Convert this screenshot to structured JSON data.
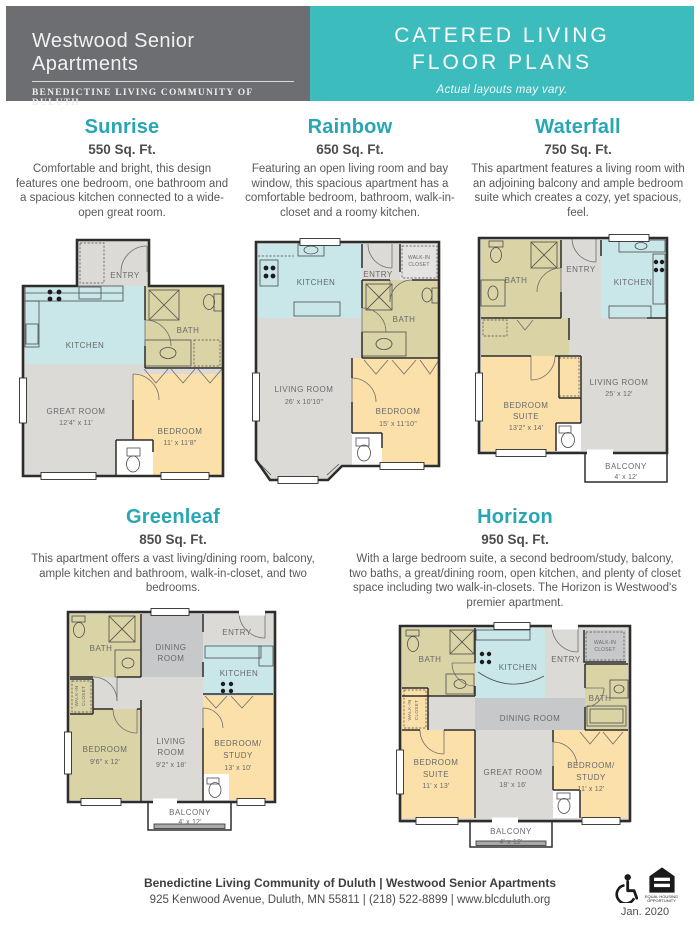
{
  "header": {
    "brand_title": "Westwood Senior Apartments",
    "brand_subtitle": "Benedictine Living Community of Duluth",
    "program_title_line1": "CATERED LIVING",
    "program_title_line2": "FLOOR PLANS",
    "disclaimer": "Actual layouts may vary."
  },
  "plans": [
    {
      "name": "Sunrise",
      "sqft": "550 Sq. Ft.",
      "description": "Comfortable and bright, this design features one bedroom, one bathroom and a spacious kitchen connected to a wide-open great room.",
      "rooms": {
        "entry": "ENTRY",
        "kitchen": "KITCHEN",
        "bath": "BATH",
        "great_room": "GREAT ROOM",
        "great_room_dims": "12'4\" x 11'",
        "bedroom": "BEDROOM",
        "bedroom_dims": "11' x 11'8\""
      }
    },
    {
      "name": "Rainbow",
      "sqft": "650 Sq. Ft.",
      "description": "Featuring an open living room and bay window, this spacious apartment has a comfortable bedroom, bathroom, walk-in-closet and a roomy kitchen.",
      "rooms": {
        "kitchen": "KITCHEN",
        "entry": "ENTRY",
        "walk_in_1": "WALK-IN",
        "walk_in_2": "CLOSET",
        "bath": "BATH",
        "living_room": "LIVING ROOM",
        "living_room_dims": "26' x 10'10\"",
        "bedroom": "BEDROOM",
        "bedroom_dims": "15' x 11'10\""
      }
    },
    {
      "name": "Waterfall",
      "sqft": "750 Sq. Ft.",
      "description": "This apartment features a living room with an adjoining balcony and ample bedroom suite which creates a cozy, yet spacious, feel.",
      "rooms": {
        "bath": "BATH",
        "entry": "ENTRY",
        "kitchen": "KITCHEN",
        "bedroom_suite_1": "BEDROOM",
        "bedroom_suite_2": "SUITE",
        "bedroom_suite_dims": "13'2\" x 14'",
        "living_room": "LIVING ROOM",
        "living_room_dims": "25' x 12'",
        "balcony": "BALCONY",
        "balcony_dims": "4' x 12'"
      }
    },
    {
      "name": "Greenleaf",
      "sqft": "850 Sq. Ft.",
      "description": "This apartment offers a vast living/dining room, balcony, ample kitchen and bathroom, walk-in-closet, and two bedrooms.",
      "rooms": {
        "bath": "BATH",
        "dining_1": "DINING",
        "dining_2": "ROOM",
        "entry": "ENTRY",
        "kitchen": "KITCHEN",
        "walk_in_1": "WALK-IN",
        "walk_in_2": "CLOSET",
        "bedroom": "BEDROOM",
        "bedroom_dims": "9'6\" x 12'",
        "living_1": "LIVING",
        "living_2": "ROOM",
        "living_dims": "9'2\" x 18'",
        "bedroom_study_1": "BEDROOM/",
        "bedroom_study_2": "STUDY",
        "bedroom_study_dims": "13' x 10'",
        "balcony": "BALCONY",
        "balcony_dims": "4' x 12'"
      }
    },
    {
      "name": "Horizon",
      "sqft": "950 Sq. Ft.",
      "description": "With a large bedroom suite, a second bedroom/study, balcony, two baths, a great/dining room, open kitchen, and plenty of closet space including two walk-in-closets. The Horizon is Westwood's premier apartment.",
      "rooms": {
        "bath1": "BATH",
        "kitchen": "KITCHEN",
        "entry": "ENTRY",
        "walk_in_right_1": "WALK-IN",
        "walk_in_right_2": "CLOSET",
        "bath2": "BATH",
        "walk_in_left_1": "WALK-IN",
        "walk_in_left_2": "CLOSET",
        "dining": "DINING ROOM",
        "bedroom_suite_1": "BEDROOM",
        "bedroom_suite_2": "SUITE",
        "bedroom_suite_dims": "11' x 13'",
        "great_room": "GREAT ROOM",
        "great_room_dims": "18' x 16'",
        "bedroom_study_1": "BEDROOM/",
        "bedroom_study_2": "STUDY",
        "bedroom_study_dims": "11' x 12'",
        "balcony": "BALCONY",
        "balcony_dims": "4' x 12'"
      }
    }
  ],
  "footer": {
    "line1": "Benedictine Living Community of Duluth | Westwood Senior Apartments",
    "line2": "925 Kenwood Avenue, Duluth, MN 55811 | (218) 522-8899 | www.blcduluth.org",
    "equal_housing_label": "EQUAL HOUSING OPPORTUNITY",
    "date": "Jan. 2020"
  },
  "palette": {
    "header-gray": "#6d6e71",
    "teal": "#3dbcbe",
    "heading-teal": "#27a6b4",
    "text-dark": "#58595b",
    "room-kitchen": "#c9e6e8",
    "room-olive": "#d9d3a5",
    "room-bedroom": "#fbe0a9",
    "room-living": "#dcdad7",
    "room-dining": "#c7c8ca"
  }
}
